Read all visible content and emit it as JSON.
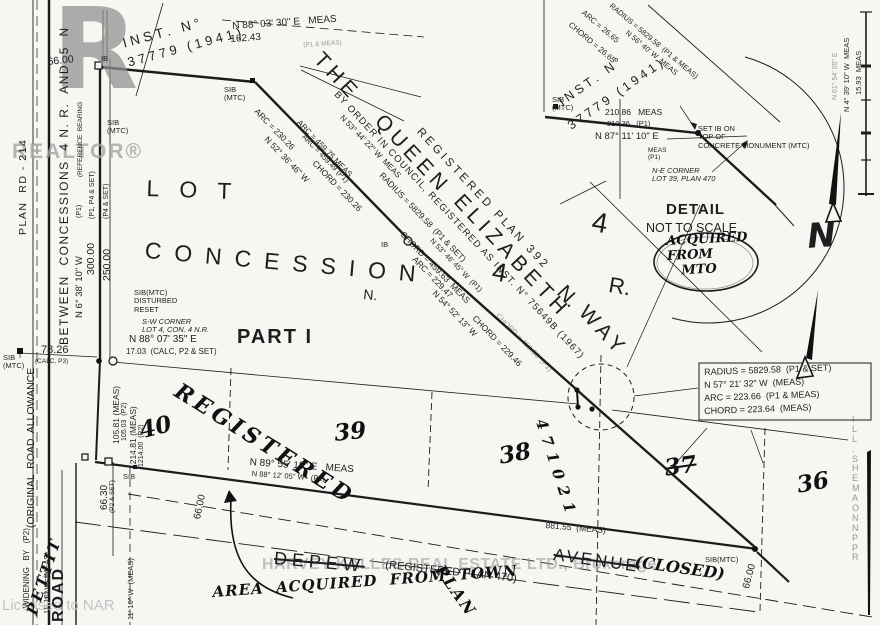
{
  "colors": {
    "ink": "#1c1c1c",
    "paper": "#f7f6f2",
    "watermark": "#a5a5a5"
  },
  "labels": [
    {
      "id": "realtor-logo-r",
      "t": "R",
      "x": 52,
      "y": 0,
      "s": 112,
      "c": "logo"
    },
    {
      "id": "realtor-wordmark",
      "t": "REALTOR®",
      "x": 12,
      "y": 140,
      "s": 21,
      "c": "logo2",
      "ls": 2
    },
    {
      "id": "licensed-to-nar",
      "t": "Licensed to NAR",
      "x": 2,
      "y": 598,
      "s": 15,
      "c": "wm"
    },
    {
      "id": "harvey-kalles-watermark",
      "t": "HARVEY KALLES REAL ESTATE LTD., Brokerage",
      "x": 262,
      "y": 556,
      "s": 16,
      "c": "wm2",
      "ls": 0.5
    },
    {
      "id": "plan-rd-214",
      "t": "PLAN  RD - 214",
      "x": 18,
      "y": 235,
      "r": -90,
      "s": 10.5,
      "ls": 1.5
    },
    {
      "id": "original-road-allowance",
      "t": "(ORIGINAL  ROAD  ALLOWANCE",
      "x": 26,
      "y": 528,
      "r": -90,
      "s": 10.5
    },
    {
      "id": "between-concessions",
      "t": "BETWEEN  CONCESSIONS  4 N. R.  AND  5  N",
      "x": 58,
      "y": 345,
      "r": -90,
      "s": 12,
      "ls": 1.5
    },
    {
      "id": "pettit-hw",
      "t": "PETTIT",
      "x": 24,
      "y": 612,
      "r": -72,
      "s": 15,
      "c": "hw",
      "ls": 3
    },
    {
      "id": "road-label",
      "t": "ROAD",
      "x": 50,
      "y": 622,
      "r": -90,
      "s": 16,
      "c": "b",
      "ls": 2
    },
    {
      "id": "reference-bearing-note",
      "t": "(REFERENCE  BEARING",
      "x": 77,
      "y": 177,
      "r": -90,
      "s": 6.5
    },
    {
      "id": "note-p1",
      "t": "(P1)",
      "x": 76,
      "y": 218,
      "r": -90,
      "s": 7
    },
    {
      "id": "note-p1-p4-set",
      "t": "(P1, P4 & SET)",
      "x": 89,
      "y": 219,
      "r": -90,
      "s": 7
    },
    {
      "id": "note-p4-set",
      "t": "(P4 & SET)",
      "x": 103,
      "y": 219,
      "r": -90,
      "s": 7
    },
    {
      "id": "brg-n6-38-10",
      "t": "N 6° 38' 10\" W",
      "x": 75,
      "y": 318,
      "r": -90,
      "s": 9.5
    },
    {
      "id": "dim-300-00",
      "t": "300.00",
      "x": 86,
      "y": 275,
      "r": -90,
      "s": 10.5
    },
    {
      "id": "dim-250-00",
      "t": "250.00",
      "x": 102,
      "y": 281,
      "r": -90,
      "s": 10.5
    },
    {
      "id": "dim-66-00-top",
      "t": "66.00",
      "x": 47,
      "y": 57,
      "r": -6,
      "s": 10.5
    },
    {
      "id": "ib-marker-top",
      "t": "IB",
      "x": 101,
      "y": 55,
      "s": 7.5
    },
    {
      "id": "sib-mtc-1",
      "t": "SIB\n(MTC)",
      "x": 107,
      "y": 119,
      "s": 7.5
    },
    {
      "id": "inst-37779-left-1",
      "t": "I N S T .   N °",
      "x": 121,
      "y": 36,
      "r": -15,
      "s": 13.5
    },
    {
      "id": "inst-37779-left-2",
      "t": "3 7 7 7 9   ( 1 9 4 1 )",
      "x": 126,
      "y": 56,
      "r": -15,
      "s": 13
    },
    {
      "id": "brg-n88-03-30",
      "t": "N 88° 03' 30\" E   MEAS",
      "x": 232,
      "y": 21,
      "r": -4,
      "s": 10
    },
    {
      "id": "dim-162-43",
      "t": "162.43",
      "x": 230,
      "y": 34,
      "r": -4,
      "s": 10
    },
    {
      "id": "note-p1-meas-top",
      "t": "(P1 & MEAS)",
      "x": 303,
      "y": 42,
      "r": -4,
      "s": 6.5,
      "c": "faint"
    },
    {
      "id": "sib-mtc-2",
      "t": "SIB\n(MTC)",
      "x": 224,
      "y": 86,
      "s": 7.5
    },
    {
      "id": "qew-the",
      "t": "THE",
      "x": 326,
      "y": 48,
      "r": 47,
      "s": 21,
      "ls": 5
    },
    {
      "id": "qew-queen",
      "t": "QUEEN",
      "x": 387,
      "y": 110,
      "r": 47,
      "s": 21,
      "ls": 5
    },
    {
      "id": "qew-elizabeth",
      "t": "ELIZABETH",
      "x": 466,
      "y": 190,
      "r": 47,
      "s": 21,
      "ls": 5
    },
    {
      "id": "qew-n",
      "t": "N.",
      "x": 569,
      "y": 281,
      "r": 47,
      "s": 21
    },
    {
      "id": "qew-way",
      "t": "WAY",
      "x": 591,
      "y": 301,
      "r": 47,
      "s": 21,
      "ls": 5
    },
    {
      "id": "registered-plan-392",
      "t": "R E G I S T E R E D   P L A N   3 9 2",
      "x": 423,
      "y": 126,
      "r": 47,
      "s": 11.5
    },
    {
      "id": "by-order-in-council",
      "t": "BY ORDER IN COUNCIL, REGISTERED AS INST. N° 75649B (1967)",
      "x": 339,
      "y": 90,
      "r": 47,
      "s": 9.5,
      "ls": 1.2
    },
    {
      "id": "arc-230-26",
      "t": "ARC = 230.26",
      "x": 259,
      "y": 107,
      "r": 46,
      "s": 8.5
    },
    {
      "id": "arc-459-75",
      "t": "ARC = 459.75 MEAS",
      "x": 301,
      "y": 119,
      "r": 46,
      "s": 8
    },
    {
      "id": "arc-459-49",
      "t": "ARC = 459.49 (P1)",
      "x": 306,
      "y": 133,
      "r": 46,
      "s": 7.5
    },
    {
      "id": "brg-n52-36-46",
      "t": "N 52° 36' 46\" W",
      "x": 269,
      "y": 135,
      "r": 46,
      "s": 8.5
    },
    {
      "id": "chord-230-26",
      "t": "CHORD = 230.26",
      "x": 317,
      "y": 159,
      "r": 46,
      "s": 8.5
    },
    {
      "id": "brg-n53-44-22",
      "t": "N 53° 44' 22\" W  MEAS",
      "x": 344,
      "y": 114,
      "r": 46,
      "s": 8
    },
    {
      "id": "radius-5829-58-main",
      "t": "RADIUS = 5829.58  (P1 & SET)",
      "x": 384,
      "y": 171,
      "r": 46,
      "s": 8.5
    },
    {
      "id": "chord-459-63",
      "t": "CHORD = 459.63  MEAS",
      "x": 405,
      "y": 230,
      "r": 46,
      "s": 8.5
    },
    {
      "id": "brg-n53-46-45",
      "t": "N 53° 46' 45\" W  (P1)",
      "x": 434,
      "y": 237,
      "r": 46,
      "s": 7.5
    },
    {
      "id": "arc-229-47",
      "t": "ARC = 229.47",
      "x": 417,
      "y": 255,
      "r": 46,
      "s": 8.5
    },
    {
      "id": "brg-n54-52-13",
      "t": "N 54° 52' 13\" W",
      "x": 437,
      "y": 289,
      "r": 46,
      "s": 8.5
    },
    {
      "id": "chord-229-46",
      "t": "CHORD = 229.46",
      "x": 477,
      "y": 314,
      "r": 46,
      "s": 8.5
    },
    {
      "id": "chord-459-36",
      "t": "CHORD = 459.36  (P1)",
      "x": 500,
      "y": 312,
      "r": 46,
      "s": 7.5,
      "c": "faint"
    },
    {
      "id": "ib-on-line",
      "t": "IB",
      "x": 381,
      "y": 241,
      "s": 7.5
    },
    {
      "id": "lot-stencil",
      "t": "LOT",
      "x": 147,
      "y": 176,
      "r": 2,
      "s": 23,
      "ls": 20
    },
    {
      "id": "concession-stencil",
      "t": "CONCESSION",
      "x": 146,
      "y": 238,
      "r": 5,
      "s": 23,
      "ls": 13
    },
    {
      "id": "n-stencil",
      "t": "N.",
      "x": 364,
      "y": 287,
      "r": 5,
      "s": 14
    },
    {
      "id": "four-lot",
      "t": "4",
      "x": 495,
      "y": 257,
      "r": 10,
      "s": 26
    },
    {
      "id": "four-range",
      "t": "4",
      "x": 595,
      "y": 206,
      "r": 10,
      "s": 28
    },
    {
      "id": "r-stencil",
      "t": "R.",
      "x": 611,
      "y": 273,
      "r": 10,
      "s": 22
    },
    {
      "id": "part-1",
      "t": "PART I",
      "x": 237,
      "y": 326,
      "s": 20,
      "c": "b",
      "ls": 2
    },
    {
      "id": "sib-disturbed-reset",
      "t": "SIB(MTC)\nDISTURBED\nRESET",
      "x": 134,
      "y": 289,
      "s": 7.5
    },
    {
      "id": "sw-corner-note",
      "t": "S-W CORNER\nLOT 4, CON. 4 N.R.",
      "x": 142,
      "y": 318,
      "s": 7.5,
      "c": "i"
    },
    {
      "id": "brg-n88-07-35",
      "t": "N 88° 07' 35\" E",
      "x": 129,
      "y": 334,
      "s": 10
    },
    {
      "id": "dim-17-03",
      "t": "17.03  (CALC, P2 & SET)",
      "x": 126,
      "y": 348,
      "s": 8
    },
    {
      "id": "dim-78-26",
      "t": "78.26",
      "x": 41,
      "y": 344,
      "s": 11
    },
    {
      "id": "note-calc-p3",
      "t": "(CALC, P3)",
      "x": 35,
      "y": 358,
      "s": 6.5
    },
    {
      "id": "sib-mtc-road",
      "t": "SIB\n(MTC)",
      "x": 3,
      "y": 354,
      "s": 7.5
    },
    {
      "id": "sib-mtc-inset",
      "t": "SIB\n(MTC)",
      "x": 552,
      "y": 96,
      "s": 7.5
    },
    {
      "id": "inst-37779-right-1",
      "t": "I N S T .   N °",
      "x": 556,
      "y": 97,
      "r": -35,
      "s": 12.5
    },
    {
      "id": "inst-37779-right-2",
      "t": "3 7 7 7 9   ( 1 9 4 1 )",
      "x": 565,
      "y": 121,
      "r": -35,
      "s": 12.5
    },
    {
      "id": "radius-5829-58-inset",
      "t": "RADIUS = 5829.58  (P1 & MEAS)",
      "x": 613,
      "y": 2,
      "r": 40,
      "s": 7.5
    },
    {
      "id": "arc-26-65",
      "t": "ARC = 26.65",
      "x": 585,
      "y": 9,
      "r": 40,
      "s": 8
    },
    {
      "id": "chord-26-65",
      "t": "CHORD = 26.65",
      "x": 572,
      "y": 21,
      "r": 40,
      "s": 8
    },
    {
      "id": "brg-n56-40",
      "t": "N 56° 40' W  MEAS",
      "x": 629,
      "y": 29,
      "r": 40,
      "s": 7.5
    },
    {
      "id": "dim-210-86",
      "t": "210.86   MEAS",
      "x": 605,
      "y": 108,
      "s": 8.5
    },
    {
      "id": "dim-210-36",
      "t": "210.36   (P1)",
      "x": 607,
      "y": 120,
      "s": 7.5
    },
    {
      "id": "brg-n87-11-10",
      "t": "N 87° 11' 10\" E",
      "x": 595,
      "y": 132,
      "s": 9.5
    },
    {
      "id": "note-meas-p1",
      "t": "MEAS\n(P1)",
      "x": 648,
      "y": 147,
      "s": 6.5
    },
    {
      "id": "set-ib-note",
      "t": "SET IB ON\nTOP OF\nCONCRETE MONUMENT (MTC)",
      "x": 698,
      "y": 125,
      "s": 7.5
    },
    {
      "id": "ne-corner-note",
      "t": "N-E CORNER\nLOT 39, PLAN 470",
      "x": 652,
      "y": 167,
      "s": 7.5,
      "c": "i"
    },
    {
      "id": "detail-title",
      "t": "DETAIL",
      "x": 666,
      "y": 202,
      "s": 15,
      "c": "b",
      "ls": 1
    },
    {
      "id": "not-to-scale",
      "t": "NOT TO SCALE",
      "x": 646,
      "y": 221,
      "s": 12.5
    },
    {
      "id": "acquired-from-mto-hw",
      "t": "ACQUIRED\nFROM\n   MTO",
      "x": 666,
      "y": 235,
      "r": -3,
      "s": 13,
      "c": "hw",
      "lh": 1.15
    },
    {
      "id": "radius-box-line-1",
      "t": "RADIUS = 5829.58  (P1 & SET)",
      "x": 704,
      "y": 367,
      "r": -2,
      "s": 9
    },
    {
      "id": "radius-box-line-2",
      "t": "N 57° 21' 32\" W  (MEAS)",
      "x": 704,
      "y": 380,
      "r": -2,
      "s": 9
    },
    {
      "id": "radius-box-line-3",
      "t": "ARC = 223.66  (P1 & MEAS)",
      "x": 704,
      "y": 393,
      "r": -2,
      "s": 9
    },
    {
      "id": "radius-box-line-4",
      "t": "CHORD = 223.64  (MEAS)",
      "x": 704,
      "y": 406,
      "r": -2,
      "s": 9
    },
    {
      "id": "registered-hw",
      "t": "REGISTERED",
      "x": 183,
      "y": 379,
      "r": 32,
      "s": 22,
      "c": "hw",
      "ls": 4
    },
    {
      "id": "lot-40",
      "t": "40",
      "x": 137,
      "y": 419,
      "r": -14,
      "s": 23,
      "c": "hw"
    },
    {
      "id": "lot-39",
      "t": "39",
      "x": 333,
      "y": 421,
      "r": -6,
      "s": 23,
      "c": "hw"
    },
    {
      "id": "lot-38",
      "t": "38",
      "x": 497,
      "y": 444,
      "r": -10,
      "s": 23,
      "c": "hw"
    },
    {
      "id": "lot-37",
      "t": "37",
      "x": 663,
      "y": 456,
      "r": -8,
      "s": 23,
      "c": "hw strike"
    },
    {
      "id": "lot-36",
      "t": "36",
      "x": 795,
      "y": 473,
      "r": -10,
      "s": 23,
      "c": "hw"
    },
    {
      "id": "num-471021",
      "t": "471021",
      "x": 548,
      "y": 417,
      "r": 72,
      "s": 15,
      "c": "hw",
      "ls": 7
    },
    {
      "id": "dim-105-81",
      "t": "105.81 (MEAS)",
      "x": 112,
      "y": 444,
      "r": -90,
      "s": 8.5
    },
    {
      "id": "dim-105-03",
      "t": "105.03  (P2)",
      "x": 121,
      "y": 441,
      "r": -90,
      "s": 7
    },
    {
      "id": "dim-1214-81",
      "t": "1214.81 (MEAS)",
      "x": 129,
      "y": 469,
      "r": -90,
      "s": 8.5
    },
    {
      "id": "dim-1214-00",
      "t": "1214.00  (P2)",
      "x": 138,
      "y": 467,
      "r": -90,
      "s": 7
    },
    {
      "id": "dim-66-30",
      "t": "66.30",
      "x": 99,
      "y": 510,
      "r": -90,
      "s": 10
    },
    {
      "id": "note-p2-set",
      "t": "(P2 & SET)",
      "x": 109,
      "y": 513,
      "r": -90,
      "s": 6.5
    },
    {
      "id": "sib-marker-3",
      "t": "SIB",
      "x": 123,
      "y": 473,
      "s": 7.5
    },
    {
      "id": "brg-n89-55-15",
      "t": "N 89° 55' 15\" E   MEAS",
      "x": 250,
      "y": 457,
      "r": 4,
      "s": 10
    },
    {
      "id": "brg-n88-12-05",
      "t": "N 88° 12' 05\" W   (P2)",
      "x": 252,
      "y": 470,
      "r": 4,
      "s": 7.5
    },
    {
      "id": "dim-66-00-mid",
      "t": "66.00",
      "x": 192,
      "y": 518,
      "r": -78,
      "s": 10
    },
    {
      "id": "depew-label",
      "t": "DEPEW",
      "x": 275,
      "y": 548,
      "r": 5,
      "s": 18,
      "c": "strike",
      "ls": 5
    },
    {
      "id": "registered-plan-470",
      "t": "(REGISTERED PLAN 470)",
      "x": 386,
      "y": 559,
      "r": 6,
      "s": 11
    },
    {
      "id": "avenue-label",
      "t": "AVENUE",
      "x": 555,
      "y": 545,
      "r": 8,
      "s": 17,
      "c": "strike",
      "ls": 3
    },
    {
      "id": "closed-hw",
      "t": "(CLOSED)",
      "x": 636,
      "y": 553,
      "r": 8,
      "s": 16,
      "c": "hw"
    },
    {
      "id": "dim-881-55",
      "t": "881.55  (MEAS)",
      "x": 546,
      "y": 521,
      "r": 5,
      "s": 8.5
    },
    {
      "id": "area-acquired-from-town-hw",
      "t": "AREA  ACQUIRED  FROM  TOWN",
      "x": 212,
      "y": 584,
      "r": -4,
      "s": 15,
      "c": "hw",
      "ls": 1
    },
    {
      "id": "plan-hw",
      "t": "PLAN",
      "x": 446,
      "y": 562,
      "r": 55,
      "s": 16,
      "c": "hw",
      "ls": 2
    },
    {
      "id": "dim-66-00-corner",
      "t": "66.00",
      "x": 741,
      "y": 587,
      "r": -75,
      "s": 10
    },
    {
      "id": "sib-mtc-corner",
      "t": "SIB(MTC)",
      "x": 705,
      "y": 556,
      "s": 7.5
    },
    {
      "id": "right-edge-text",
      "t": "I\nL\nL\n.\nS\nH\nE\nM\nA\nO\nN\nN\nP\nP\nR",
      "x": 852,
      "y": 415,
      "s": 9,
      "c": "faint",
      "lh": 1.1
    },
    {
      "id": "brg-n4-39-10",
      "t": "N 4° 39' 10\" W  MEAS",
      "x": 843,
      "y": 112,
      "r": -90,
      "s": 7.5
    },
    {
      "id": "dim-15-93",
      "t": "15.93  MEAS",
      "x": 855,
      "y": 95,
      "r": -90,
      "s": 7.5
    },
    {
      "id": "brg-n61-54-05",
      "t": "N 61° 54' 05\" E",
      "x": 832,
      "y": 100,
      "r": -90,
      "s": 7,
      "c": "faint"
    },
    {
      "id": "north-letter",
      "t": "N",
      "x": 806,
      "y": 218,
      "r": -4,
      "s": 34,
      "c": "bN"
    },
    {
      "id": "widening-by-note",
      "t": "WIDENING   BY   (P2)",
      "x": 23,
      "y": 608,
      "r": -90,
      "s": 8
    },
    {
      "id": "note-2-set",
      "t": "2 & SET)",
      "x": 45,
      "y": 600,
      "r": -90,
      "s": 7
    },
    {
      "id": "brg-n1-11-10-a",
      "t": "11' 10\" W  (MEAS)",
      "x": 43,
      "y": 614,
      "r": -90,
      "s": 7.5
    },
    {
      "id": "brg-n1-11-10-b",
      "t": "11' 10\" W  (MEAS)",
      "x": 127,
      "y": 620,
      "r": -90,
      "s": 7.5
    }
  ]
}
